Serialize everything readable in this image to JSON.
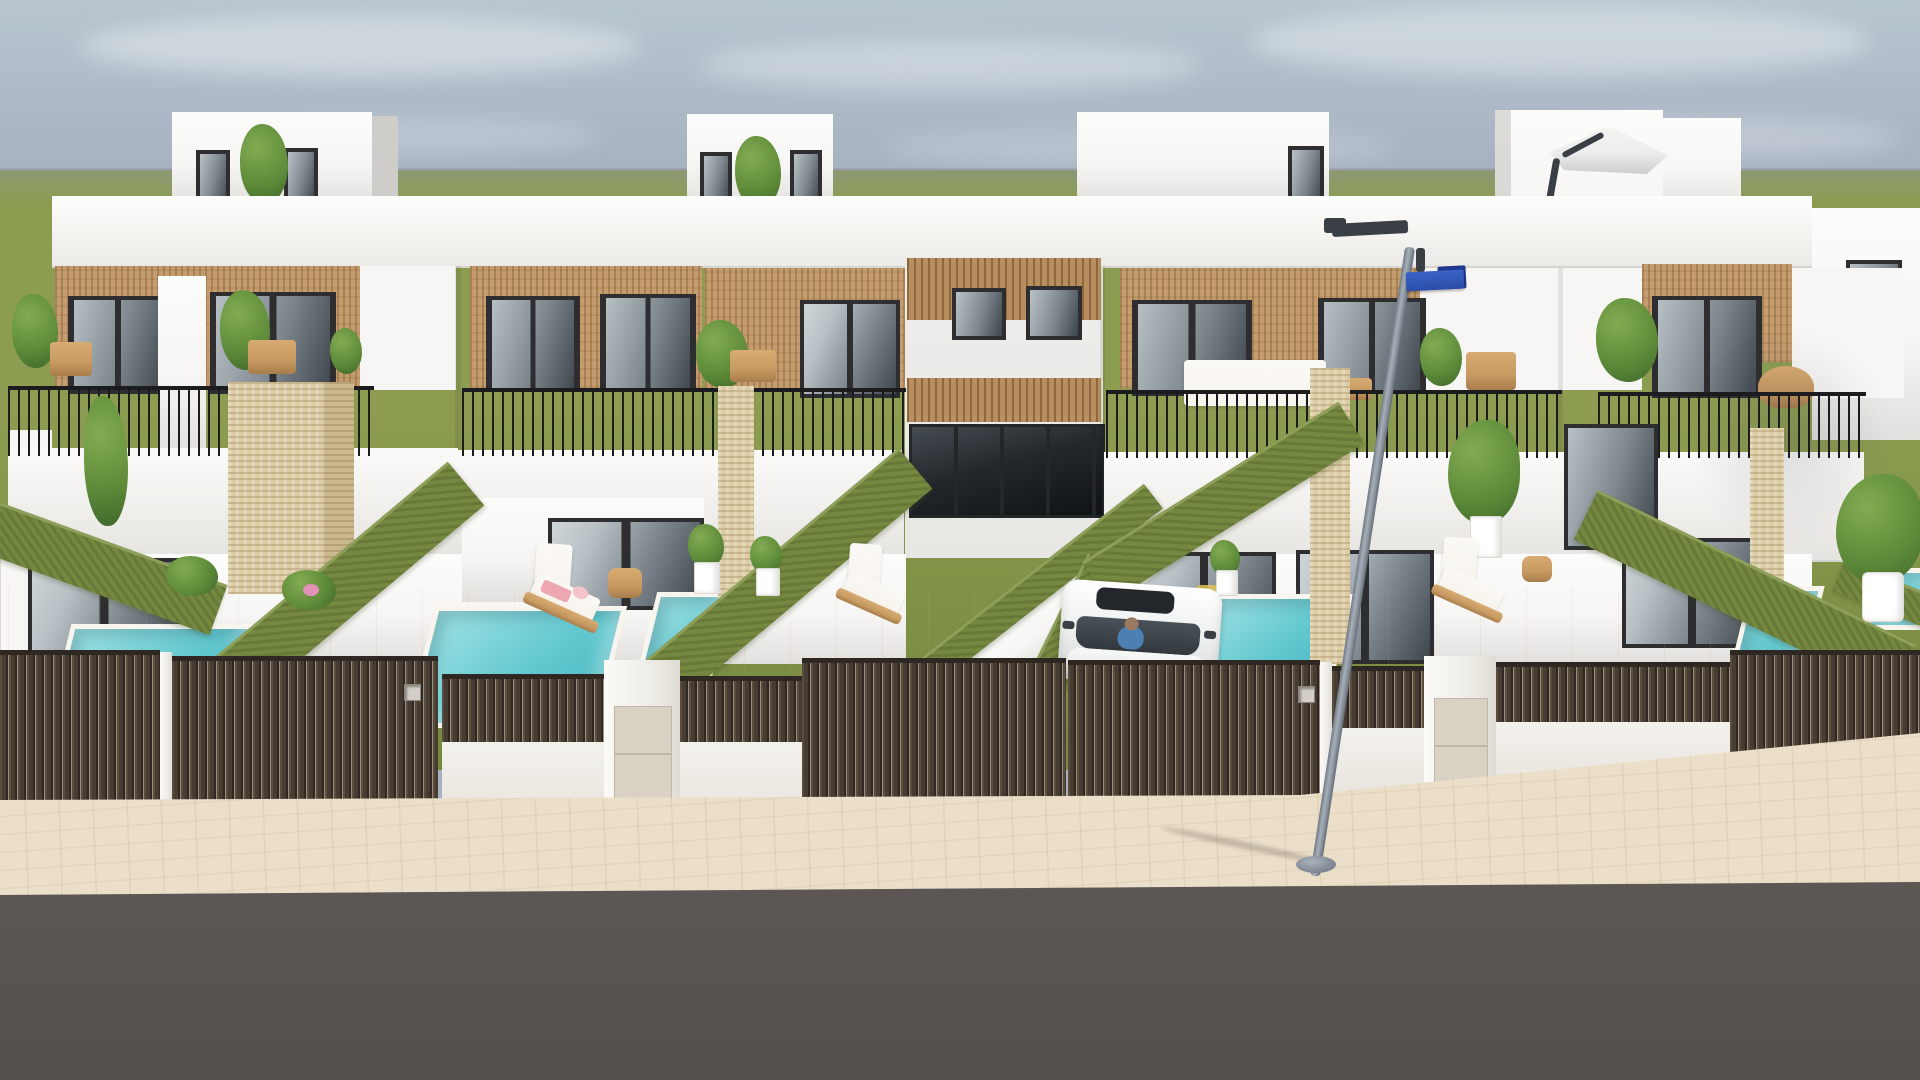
{
  "scene": {
    "description": "3D architectural rendering of a terrace of four modern white two-storey townhouses with rattan-clad upper facades, rooftop boxes and a roof parasol, balconies with thin black railings, travertine pillars, private gardens with turquoise plunge pools, green hedge dividing walls, sun loungers with pink towels, potted plants, dark brown slatted fences and gates with steel number plaques, a parked white car with driver, a grey street lamp with a blue street-name sign, beige paved sidewalk and dark asphalt road under a hazy blue-grey sky over a flat green field"
  },
  "counts": {
    "houses": 4,
    "rooftop_boxes": 3,
    "pools": 6,
    "gates": 5,
    "sun_loungers": 3,
    "cars": 1,
    "street_lamps": 1
  },
  "colors": {
    "sky_top": "#b7c5ce",
    "sky_mid": "#a7b2c1",
    "sky_low": "#949aac",
    "sky_horizon": "#8d90a2",
    "cloud": "#e6ebef",
    "grass": "#8c9d51",
    "grass_deep": "#75883e",
    "wall": "#f7f6f4",
    "wall_bright": "#fcfcfb",
    "wall_shade": "#e2e0dd",
    "wall_dark": "#cfcdc9",
    "recess": "#e9e7e4",
    "wicker": "#c59c6e",
    "frame": "#2e2e31",
    "glass_hi": "#b9c1c6",
    "glass_mid": "#7c868c",
    "glass_lo": "#3e464c",
    "rail": "#1c1c1e",
    "trav": "#ddcda6",
    "terrace": "#f1eadd",
    "terrace_hi": "#f7f1e6",
    "pool_hi": "#9fe2e4",
    "pool_mid": "#64c9d0",
    "pool_lo": "#45b5bf",
    "coping": "#f8f5ef",
    "hedge": "#75883f",
    "hedge_hi": "#8d9f58",
    "fence": "#463c32",
    "fence_dk": "#2f2822",
    "fence_hi": "#5a4d40",
    "fence_wall": "#f3f1ec",
    "panel": "#d8d1c4",
    "walk": "#ecdfc9",
    "road": "#5e5855",
    "road_dk": "#56504d",
    "car": "#f5f6f6",
    "car_sh": "#d3d5d6",
    "car_glass": "#31373d",
    "shirt": "#4c80b2",
    "skin": "#9b7a60",
    "pole": "#97a0aa",
    "sign": "#3058ba",
    "sign_dk": "#20368f",
    "wood": "#c79a62",
    "cushion": "#f6f3ec",
    "towel": "#eda6b2",
    "towel2": "#f4c3cc",
    "leaf": "#466f2d",
    "leaf_mid": "#5f8c3a",
    "leaf_hi": "#82ab52",
    "pot": "#ffffff",
    "parasol": "#eceded",
    "parasol_sh": "#cdcecc",
    "metal": "#3a3f46"
  }
}
